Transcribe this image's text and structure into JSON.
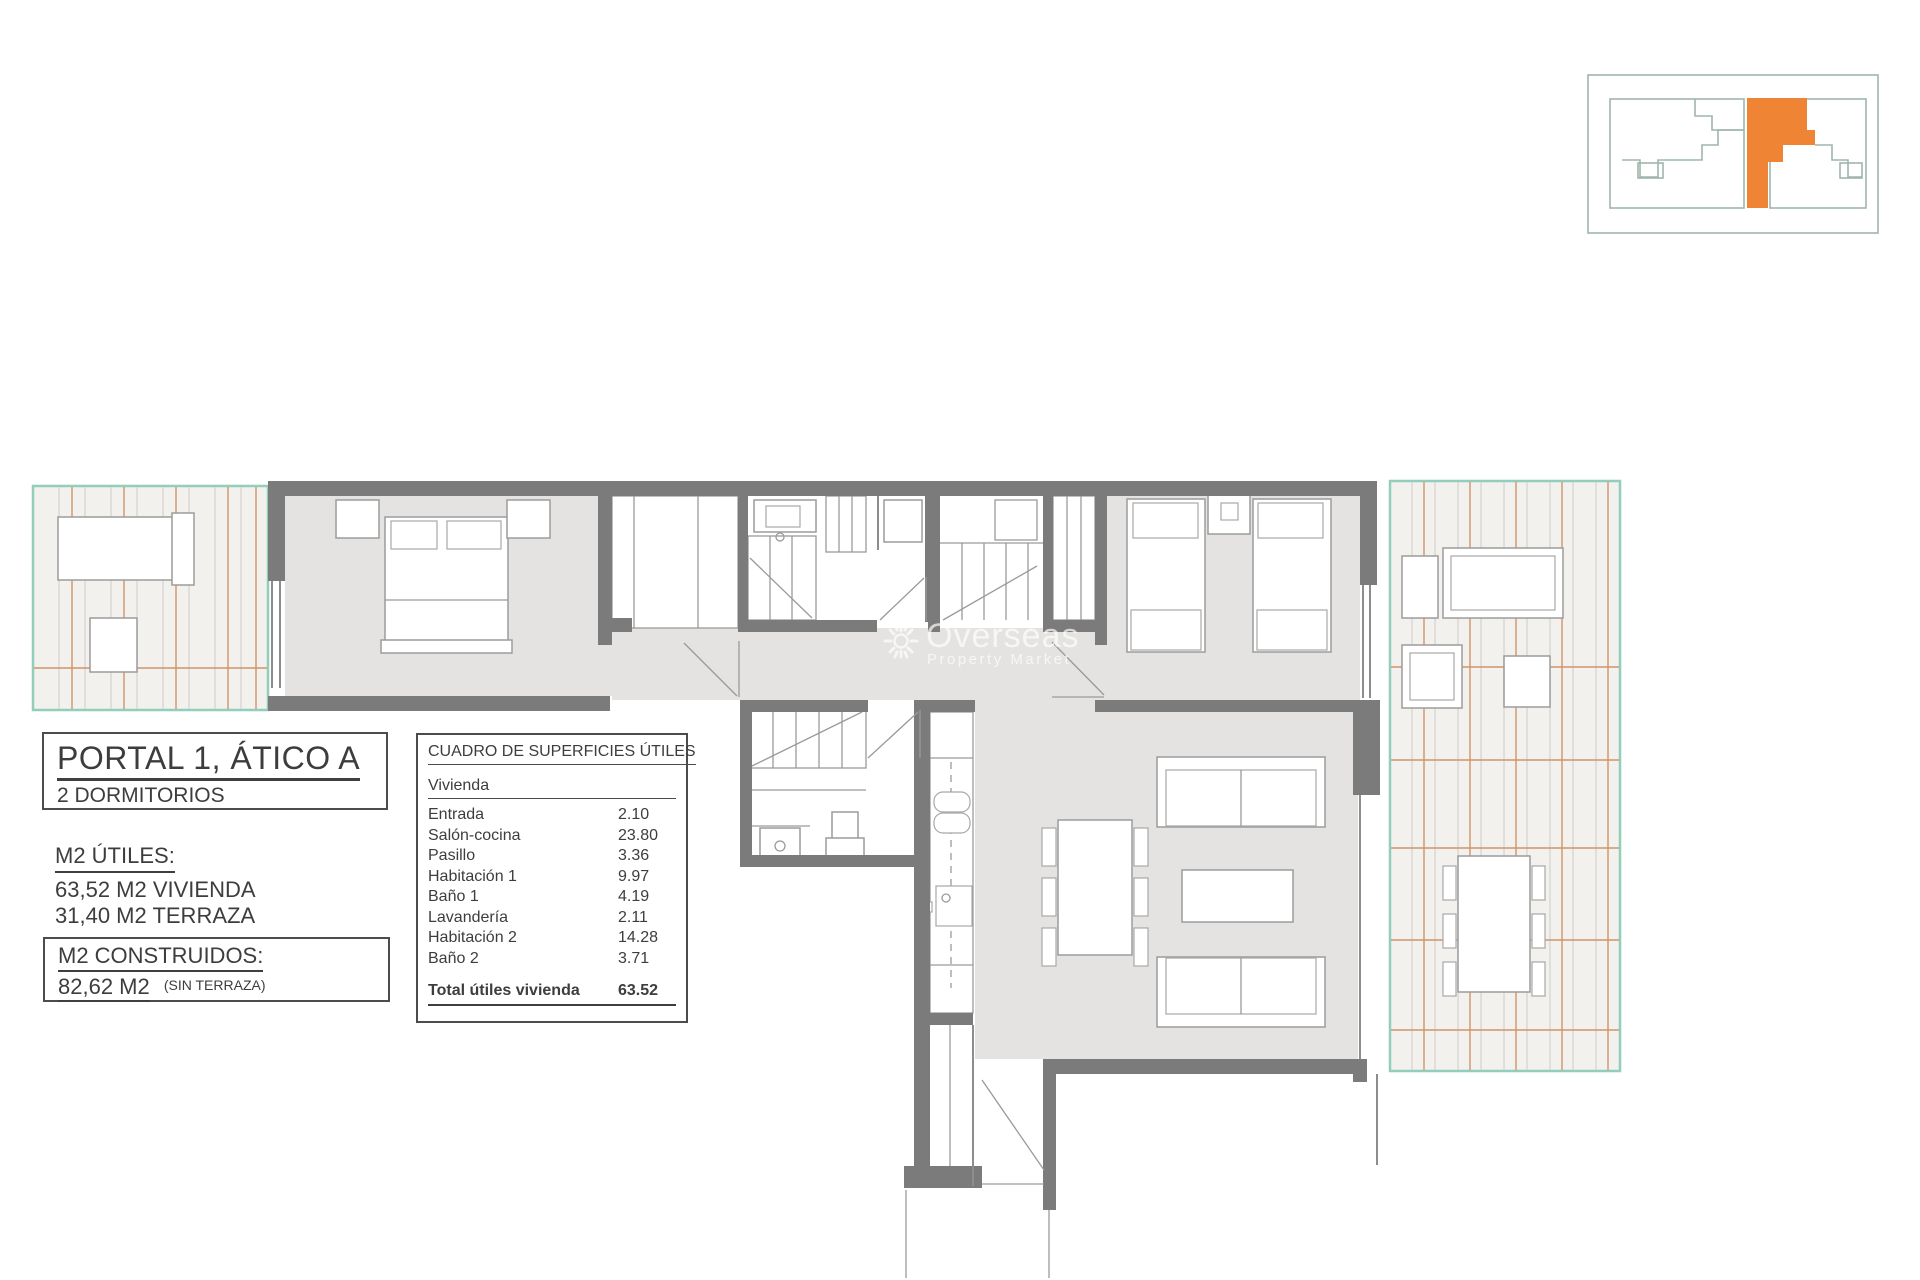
{
  "info": {
    "title": "PORTAL 1, ÁTICO A",
    "subtitle": "2 DORMITORIOS",
    "utiles_heading": "M2 ÚTILES:",
    "utiles_line1": "63,52 M2 VIVIENDA",
    "utiles_line2": "31,40 M2 TERRAZA",
    "construidos_heading": "M2 CONSTRUIDOS:",
    "construidos_value": "82,62 M2",
    "construidos_note": "(SIN TERRAZA)"
  },
  "surface_table": {
    "heading": "CUADRO DE SUPERFICIES ÚTILES",
    "group": "Vivienda",
    "rows": [
      {
        "label": "Entrada",
        "value": "2.10"
      },
      {
        "label": "Salón-cocina",
        "value": "23.80"
      },
      {
        "label": "Pasillo",
        "value": "3.36"
      },
      {
        "label": "Habitación 1",
        "value": "9.97"
      },
      {
        "label": "Baño 1",
        "value": "4.19"
      },
      {
        "label": "Lavandería",
        "value": "2.11"
      },
      {
        "label": "Habitación 2",
        "value": "14.28"
      },
      {
        "label": "Baño 2",
        "value": "3.71"
      }
    ],
    "total_label": "Total útiles vivienda",
    "total_value": "63.52"
  },
  "watermark": {
    "name": "Overseas",
    "tagline": "Property Market"
  },
  "colors": {
    "highlight": "#ee8434",
    "wall": "#7b7b7b",
    "terrace_border": "#93cebc"
  }
}
